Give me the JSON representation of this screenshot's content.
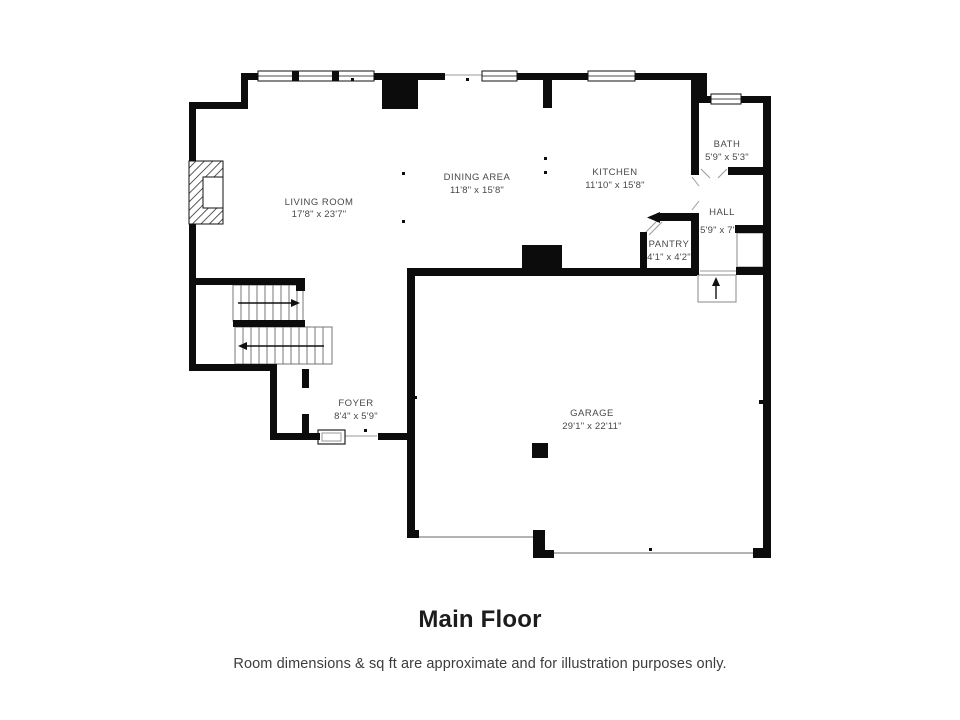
{
  "page": {
    "title": "Main Floor",
    "disclaimer": "Room dimensions & sq ft are approximate and for illustration purposes only."
  },
  "floor_plan": {
    "rooms": [
      {
        "name": "LIVING ROOM",
        "dimensions": "17'8\" x 23'7\""
      },
      {
        "name": "DINING AREA",
        "dimensions": "11'8\" x 15'8\""
      },
      {
        "name": "KITCHEN",
        "dimensions": "11'10\" x 15'8\""
      },
      {
        "name": "BATH",
        "dimensions": "5'9\" x 5'3\""
      },
      {
        "name": "HALL",
        "dimensions": "5'9\" x 7'0\""
      },
      {
        "name": "PANTRY",
        "dimensions": "4'1\" x 4'2\""
      },
      {
        "name": "FOYER",
        "dimensions": "8'4\" x 5'9\""
      },
      {
        "name": "GARAGE",
        "dimensions": "29'1\" x 22'11\""
      }
    ],
    "features": [
      "fireplace",
      "staircase-two-flights",
      "triple-window",
      "bath-window",
      "front-door",
      "entry-stoop",
      "hall-closet",
      "pantry-door",
      "garage-post",
      "garage-door-openings"
    ],
    "symbols": {
      "stair_up_arrow": "→",
      "stair_down_arrow": "←",
      "entry_arrow": "▲"
    },
    "colors": {
      "wall": "#0c0c0c",
      "label_text": "#484848",
      "title_text": "#1c1c1e",
      "thin_line": "#999999",
      "background": "#ffffff"
    }
  }
}
